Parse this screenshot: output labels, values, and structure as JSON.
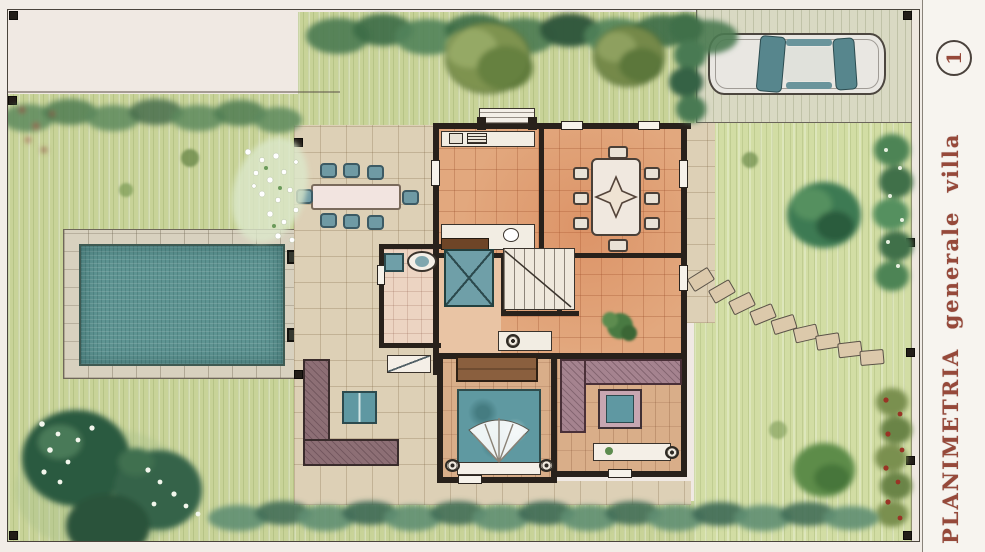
{
  "sheet": {
    "margin_title": "PLANIMETRIA generale villa",
    "sheet_number": "1",
    "title_color": "#96493a"
  },
  "drawing": {
    "kind": "hand-drawn watercolor site plan (top view) of a villa and garden",
    "elements": [
      "villa floor plan",
      "kitchen with counters",
      "dining room with table, eight chairs and star floor motif",
      "bathroom with sink, basin and shower",
      "staircase",
      "living area with plant and console",
      "bedroom with double bed, wardrobe and bedside tables",
      "lounge with corner sofa, coffee table and shelf",
      "west terrace with outdoor dining table and eight chairs",
      "outdoor corner bench with square table",
      "rectangular swimming pool with stone deck and two skimmers",
      "parking area with parked car",
      "stepping-stone path",
      "perimeter hedges and trees",
      "flower beds",
      "fence posts"
    ]
  },
  "palette": {
    "paper": "#f2ede7",
    "lawn": "#c8d398",
    "lawn_light": "#d2dda4",
    "patio": "#ddd0b6",
    "pool_water": "#5e9492",
    "pool_deck": "#d8d1bf",
    "terracotta_floor": "#e2a87e",
    "wall": "#28211b",
    "hedge": "#4a7a52",
    "dark_tree": "#2c5a40",
    "olive_tree": "#7e9350",
    "teal_furniture": "#6f9aa4",
    "mauve_sofa": "#a5838f",
    "car_body": "#e9e7e2",
    "car_glass": "#57868d",
    "flower_red": "#993425",
    "title": "#96493a"
  }
}
